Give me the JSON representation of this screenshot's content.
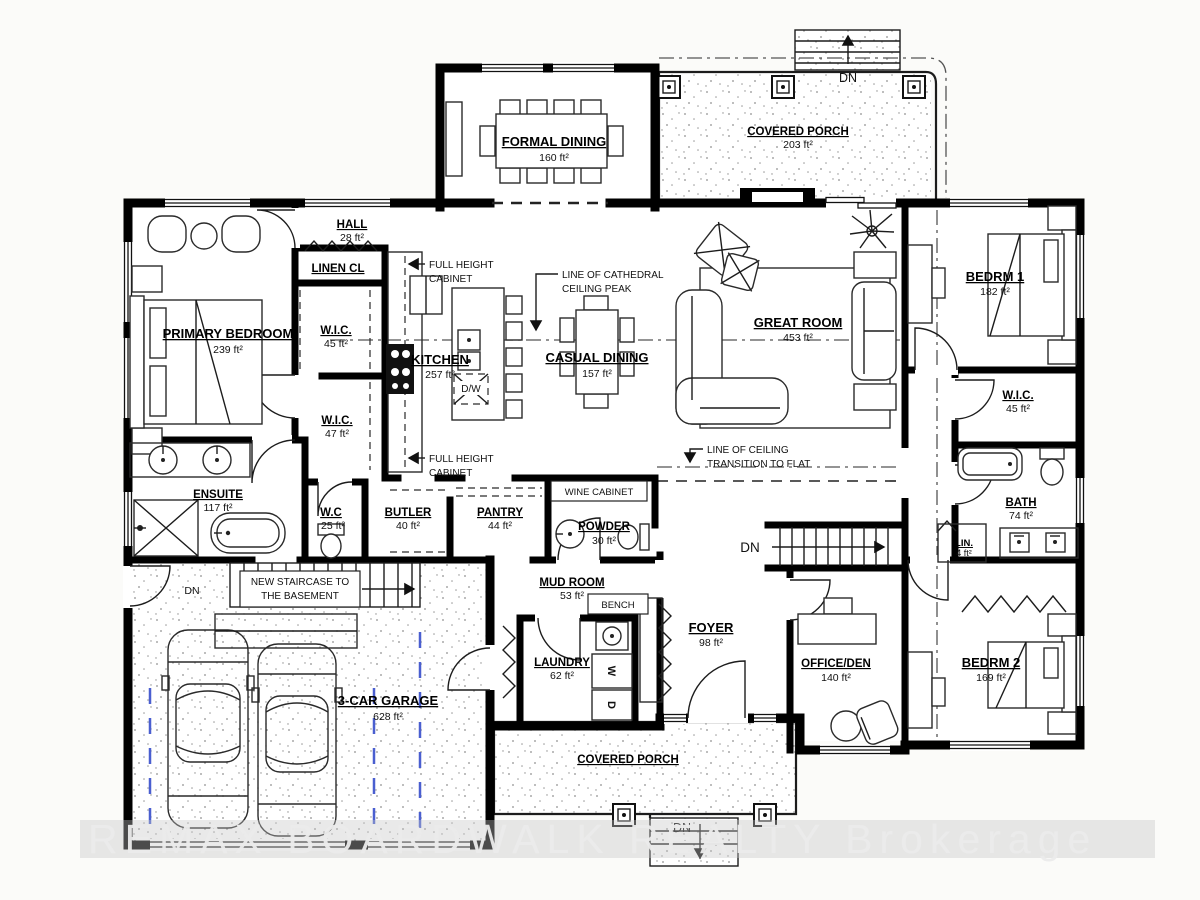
{
  "plan": {
    "rooms": {
      "formal_dining": {
        "name": "FORMAL DINING",
        "area": "160 ft²"
      },
      "covered_porch_top": {
        "name": "COVERED PORCH",
        "area": "203 ft²"
      },
      "hall": {
        "name": "HALL",
        "area": "28 ft²"
      },
      "linen": {
        "name": "LINEN CL"
      },
      "primary_bedroom": {
        "name": "PRIMARY BEDROOM",
        "area": "239 ft²"
      },
      "wic1": {
        "name": "W.I.C.",
        "area": "45 ft²"
      },
      "wic2": {
        "name": "W.I.C.",
        "area": "47 ft²"
      },
      "kitchen": {
        "name": "KITCHEN",
        "area": "257 ft²"
      },
      "casual_dining": {
        "name": "CASUAL DINING",
        "area": "157 ft²"
      },
      "great_room": {
        "name": "GREAT ROOM",
        "area": "453 ft²"
      },
      "bedrm1": {
        "name": "BEDRM 1",
        "area": "182 ft²"
      },
      "wic3": {
        "name": "W.I.C.",
        "area": "45 ft²"
      },
      "ensuite": {
        "name": "ENSUITE",
        "area": "117 ft²"
      },
      "wc": {
        "name": "W.C",
        "area": "25 ft²"
      },
      "butler": {
        "name": "BUTLER",
        "area": "40 ft²"
      },
      "pantry": {
        "name": "PANTRY",
        "area": "44 ft²"
      },
      "powder": {
        "name": "POWDER",
        "area": "30 ft²"
      },
      "bath": {
        "name": "BATH",
        "area": "74 ft²"
      },
      "lin": {
        "name": "LIN.",
        "area": "4 ft²"
      },
      "mud_room": {
        "name": "MUD ROOM",
        "area": "53 ft²"
      },
      "foyer": {
        "name": "FOYER",
        "area": "98 ft²"
      },
      "office_den": {
        "name": "OFFICE/DEN",
        "area": "140 ft²"
      },
      "bedrm2": {
        "name": "BEDRM 2",
        "area": "169 ft²"
      },
      "laundry": {
        "name": "LAUNDRY",
        "area": "62 ft²"
      },
      "garage": {
        "name": "3-CAR GARAGE",
        "area": "628 ft²"
      },
      "covered_porch_bottom": {
        "name": "COVERED PORCH"
      }
    },
    "annotations": {
      "full_height_1": "FULL HEIGHT",
      "full_height_2": "CABINET",
      "cathedral_1": "LINE OF CATHEDRAL",
      "cathedral_2": "CEILING PEAK",
      "ceiling_flat_1": "LINE OF CEILING",
      "ceiling_flat_2": "TRANSITION TO FLAT",
      "wine_cabinet": "WINE CABINET",
      "bench": "BENCH",
      "staircase_1": "NEW STAIRCASE TO",
      "staircase_2": "THE BASEMENT",
      "dn": "DN",
      "dw": "D/W",
      "washer": "W",
      "dryer": "D"
    },
    "watermark": "REMAX BOARDWALK REALTY Brokerage",
    "colors": {
      "wall": "#000000",
      "stipple": "#8f8f8f",
      "parking_line": "#4a5fd0",
      "watermark_text": "#ececec",
      "watermark_band": "#c6c6c6"
    }
  }
}
